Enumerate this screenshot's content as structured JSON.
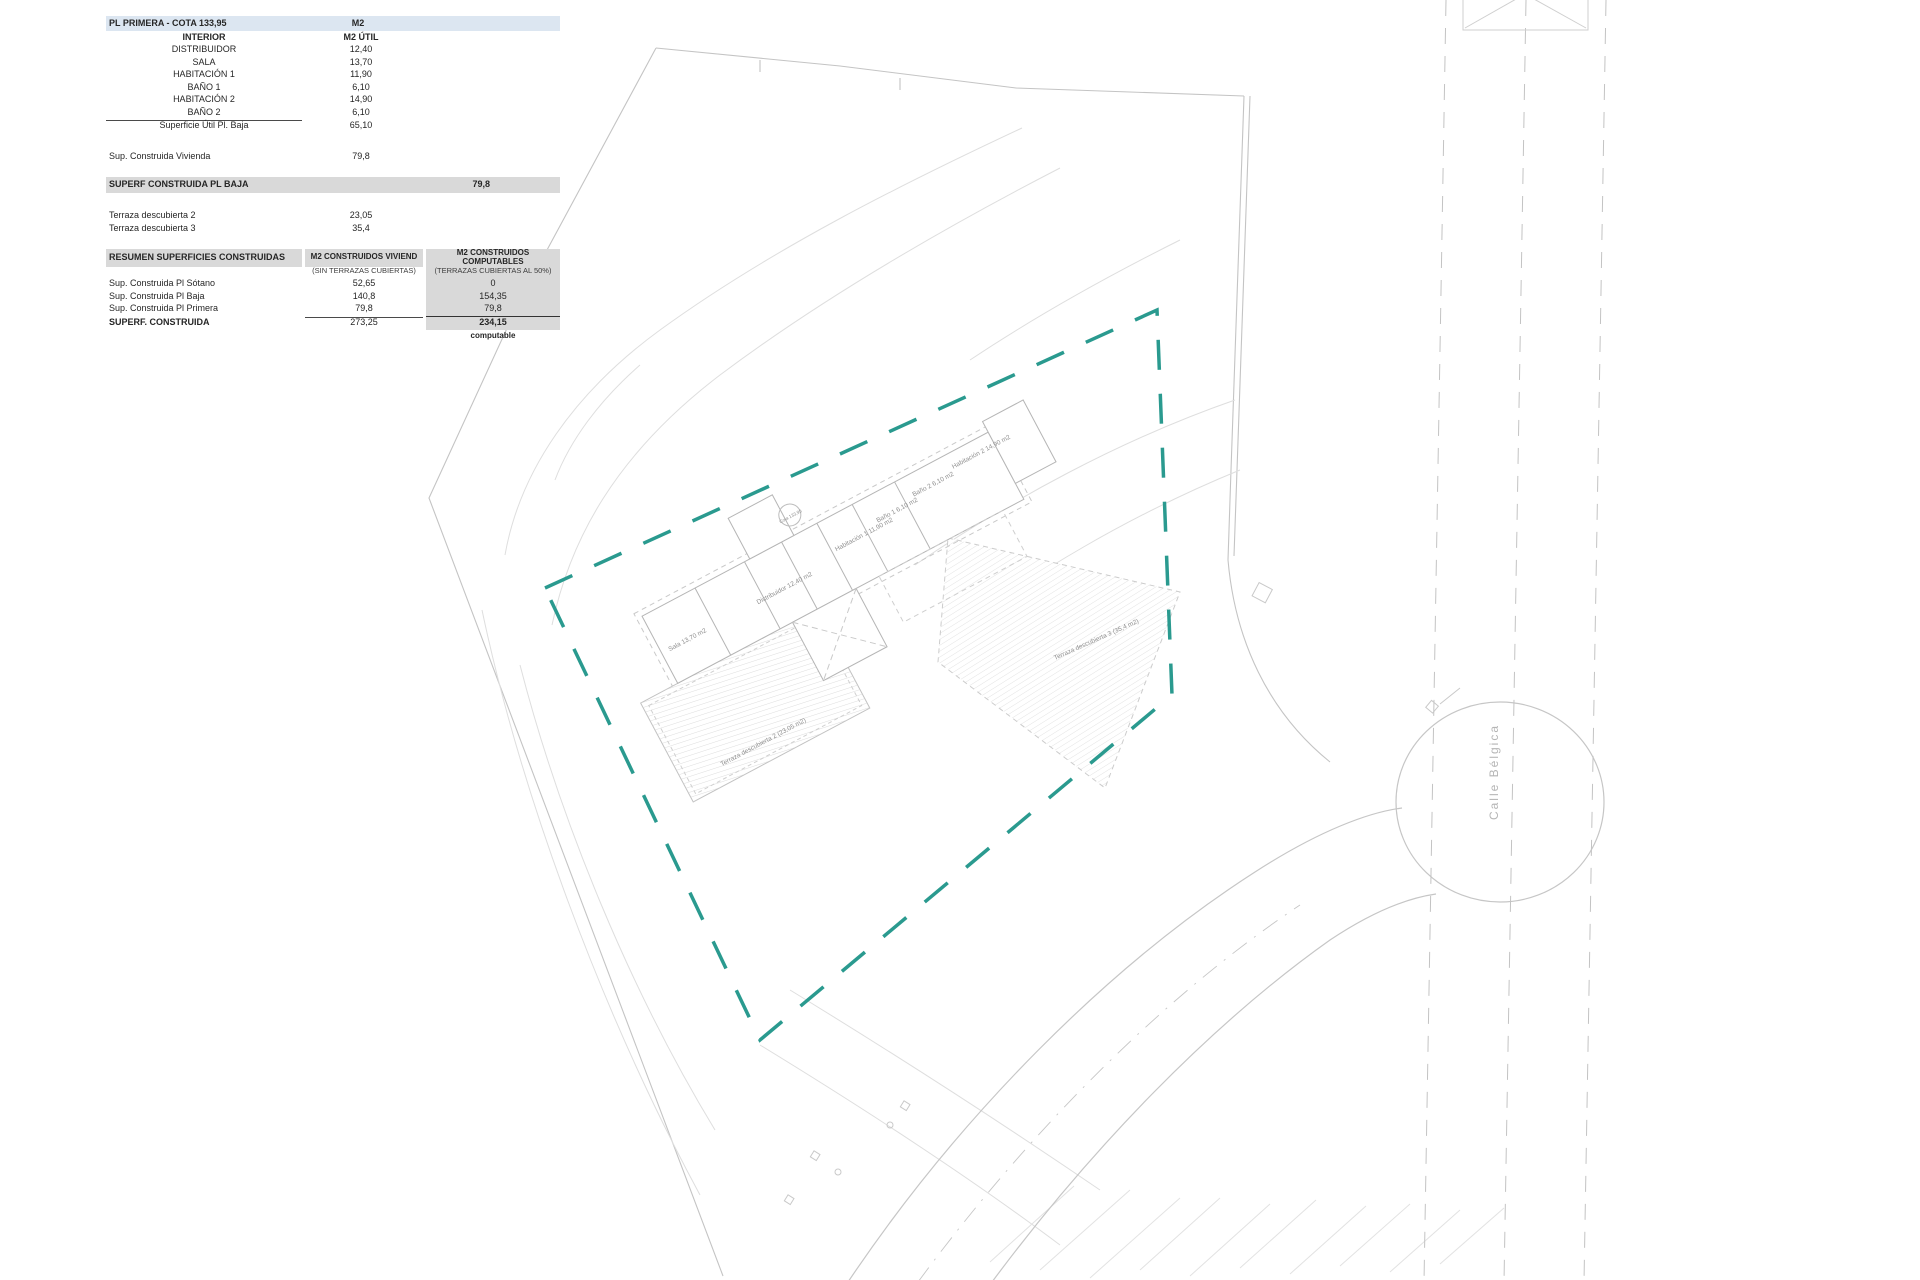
{
  "plan_table": {
    "title": "PL PRIMERA - COTA 133,95",
    "title_unit": "M2",
    "subheader_label": "INTERIOR",
    "subheader_unit": "M2 ÚTIL",
    "rooms": [
      {
        "label": "DISTRIBUIDOR",
        "value": "12,40"
      },
      {
        "label": "SALA",
        "value": "13,70"
      },
      {
        "label": "HABITACIÓN 1",
        "value": "11,90"
      },
      {
        "label": "BAÑO 1",
        "value": "6,10"
      },
      {
        "label": "HABITACIÓN 2",
        "value": "14,90"
      },
      {
        "label": "BAÑO 2",
        "value": "6,10"
      }
    ],
    "subtotal": {
      "label": "Superficie Útil Pl. Baja",
      "value": "65,10"
    },
    "construida_vivienda": {
      "label": "Sup. Construida Vivienda",
      "value": "79,8"
    },
    "superf_bar": {
      "label": "SUPERF CONSTRUIDA PL BAJA",
      "value": "79,8"
    },
    "terrazas": [
      {
        "label": "Terraza descubierta 2",
        "value": "23,05"
      },
      {
        "label": "Terraza descubierta 3",
        "value": "35,4"
      }
    ]
  },
  "summary_table": {
    "header_col1": "RESUMEN SUPERFICIES CONSTRUIDAS",
    "header_col2": "M2 CONSTRUIDOS VIVIEND",
    "header_col3": "M2 CONSTRUIDOS COMPUTABLES",
    "subheader_col2": "(SIN TERRAZAS CUBIERTAS)",
    "subheader_col3": "(TERRAZAS CUBIERTAS AL 50%)",
    "rows": [
      {
        "label": "Sup. Construida Pl Sótano",
        "viviend": "52,65",
        "computable": "0"
      },
      {
        "label": "Sup. Construida Pl Baja",
        "viviend": "140,8",
        "computable": "154,35"
      },
      {
        "label": "Sup. Construida Pl Primera",
        "viviend": "79,8",
        "computable": "79,8"
      }
    ],
    "total": {
      "label": "SUPERF. CONSTRUIDA",
      "viviend": "273,25",
      "computable": "234,15"
    },
    "footnote": "computable"
  },
  "site_plan": {
    "street_label": "Calle Bélgica",
    "cota_marker": "Cota 133,95",
    "room_labels": [
      "Sala 13,70 m2",
      "Distribuidor 12,40 m2",
      "Habitación 1 11,90 m2",
      "Baño 1 6,10 m2",
      "Baño 2 6,10 m2",
      "Habitación 2 14,90 m2",
      "Terraza descubierta 2 (23,05 m2)",
      "Terraza descubierta 3 (35,4 m2)"
    ],
    "colors": {
      "boundary_teal": "#2a9a8f",
      "linework": "#c4c4c4",
      "contour": "#dedede",
      "header_blue": "#dce6f1",
      "header_gray": "#d9d9d9"
    }
  }
}
